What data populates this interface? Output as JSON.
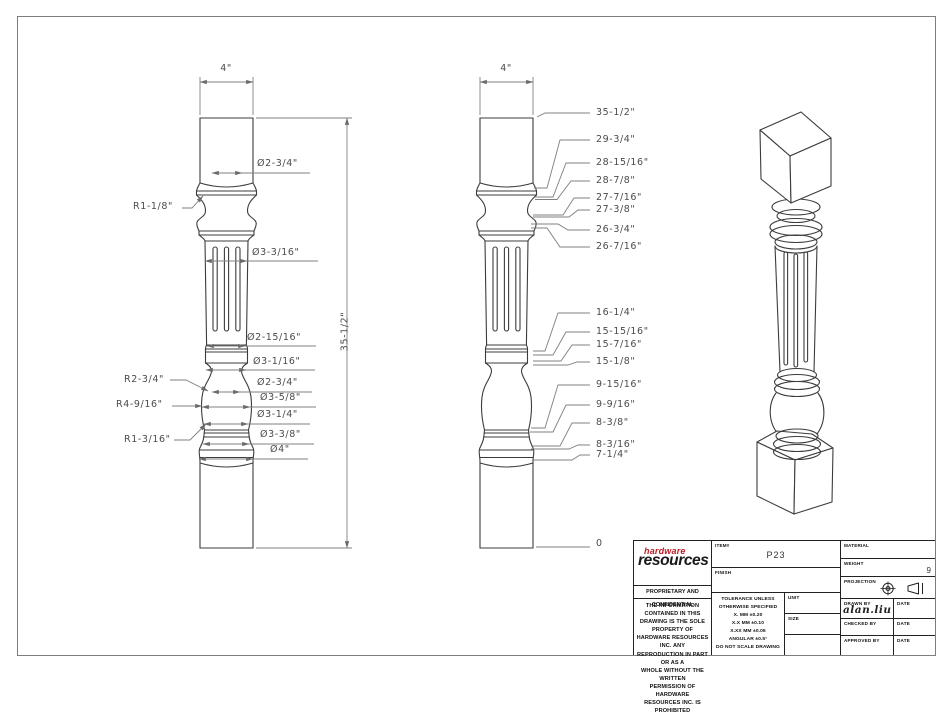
{
  "front_view": {
    "width_dim": "4\"",
    "height_dim": "35-1/2\"",
    "dia_neck_top": "Ø2-3/4\"",
    "r_neck": "R1-1/8\"",
    "dia_flute": "Ø3-3/16\"",
    "dia_shaft_bottom": "Ø2-15/16\"",
    "dia_bead": "Ø3-1/16\"",
    "r_vase_top": "R2-3/4\"",
    "dia_vase_top": "Ø2-3/4\"",
    "dia_vase_max": "Ø3-5/8\"",
    "r_vase": "R4-9/16\"",
    "dia_vase_bottom": "Ø3-1/4\"",
    "r_base_cove": "R1-3/16\"",
    "dia_ring": "Ø3-3/8\"",
    "dia_flare": "Ø4\""
  },
  "profile_view": {
    "width_dim": "4\"",
    "callouts": [
      "35-1/2\"",
      "29-3/4\"",
      "28-15/16\"",
      "28-7/8\"",
      "27-7/16\"",
      "27-3/8\"",
      "26-3/4\"",
      "26-7/16\"",
      "16-1/4\"",
      "15-15/16\"",
      "15-7/16\"",
      "15-1/8\"",
      "9-15/16\"",
      "9-9/16\"",
      "8-3/8\"",
      "8-3/16\"",
      "7-1/4\"",
      "0"
    ]
  },
  "title_block": {
    "logo_line1": "hardware",
    "logo_line2": "resources",
    "item_label": "ITEM#",
    "item_value": "P23",
    "finish_label": "FINISH",
    "material_label": "MATERIAL",
    "weight_label": "WEIGHT",
    "weight_value": "9",
    "projection_label": "PROJECTION",
    "proprietary_title": "PROPRIETARY AND CONFIDENTIAL",
    "proprietary_lines": [
      "THE INFORMATION CONTAINED IN THIS",
      "DRAWING IS THE SOLE PROPERTY OF",
      "HARDWARE RESOURCES INC.  ANY",
      "REPRODUCTION IN PART OR AS A",
      "WHOLE  WITHOUT THE WRITTEN",
      "PERMISSION OF HARDWARE",
      "RESOURCES INC. IS PROHIBITED"
    ],
    "tolerance_lines": [
      "TOLERANCE UNLESS",
      "OTHERWISE SPECIFIED",
      "X.   MM   ±0.20",
      "X.X   MM   ±0.10",
      "X.XX  MM   ±0.05",
      "ANGULAR    ±0.5°",
      "DO NOT SCALE DRAWING"
    ],
    "unit_label": "UNIT",
    "size_label": "SIZE",
    "drawn_by_label": "DRAWN BY",
    "drawn_by_value": "alan.liu",
    "checked_by_label": "CHECKED BY",
    "approved_by_label": "APPROVED BY",
    "date_label": "DATE"
  }
}
